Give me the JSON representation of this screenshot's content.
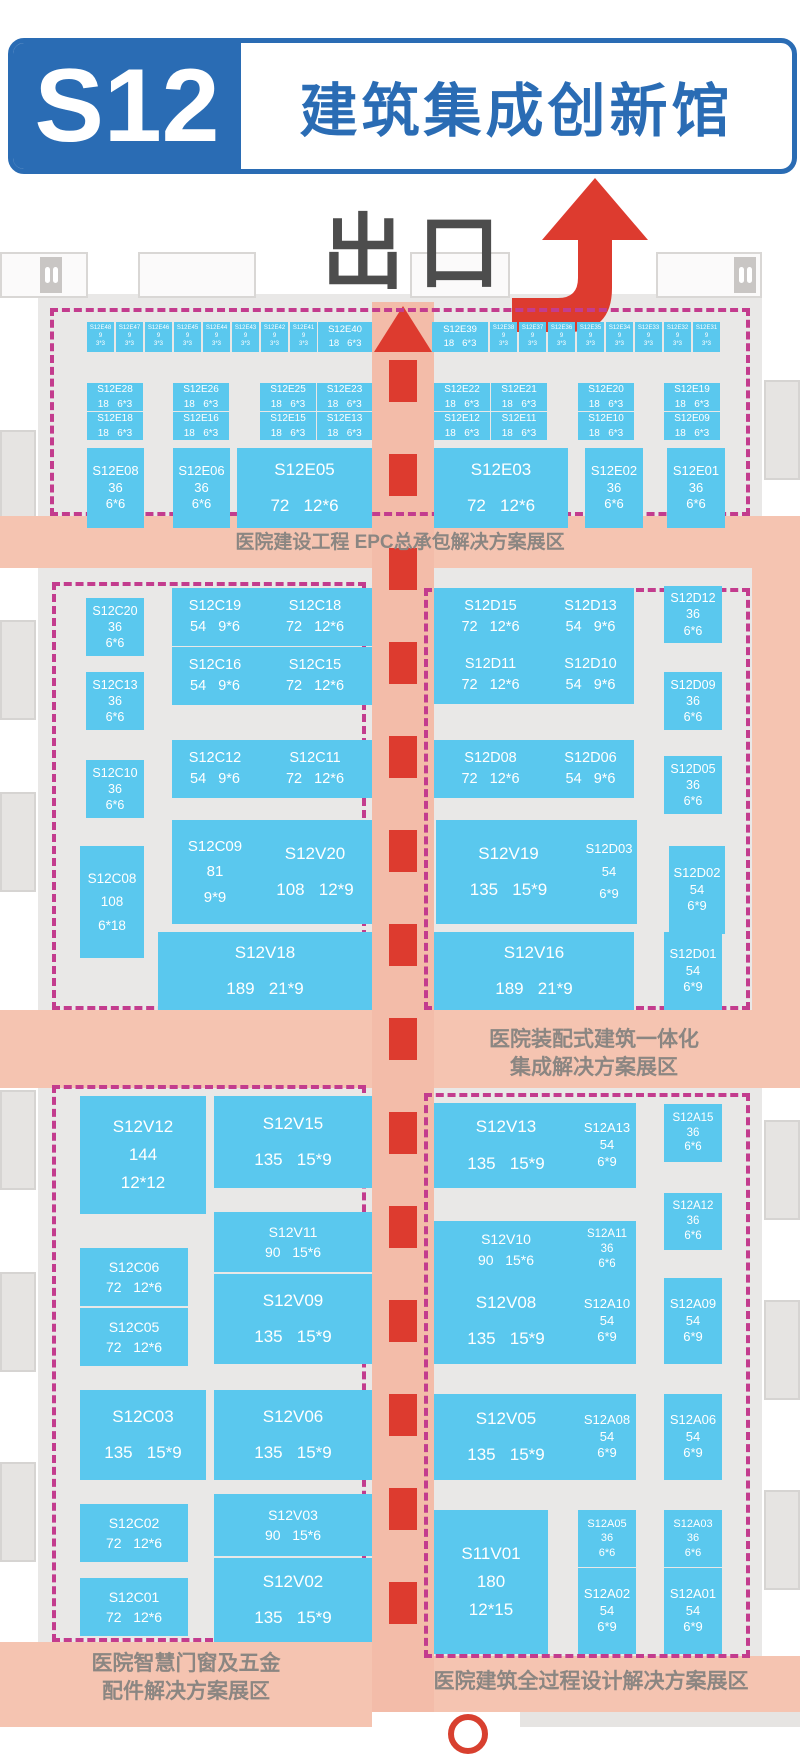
{
  "header": {
    "hall_code": "S12",
    "hall_name": "建筑集成创新馆"
  },
  "exit_label": "出口",
  "zones": {
    "epc": "医院建设工程 EPC总承包解决方案展区",
    "prefab_line1": "医院装配式建筑一体化",
    "prefab_line2": "集成解决方案展区",
    "windows_line1": "医院智慧门窗及五金",
    "windows_line2": "配件解决方案展区",
    "design": "医院建筑全过程设计解决方案展区"
  },
  "colors": {
    "header_blue": "#2a6cb4",
    "booth_cyan": "#5ac8ee",
    "zone_salmon": "#f5c4b1",
    "corridor_salmon": "#f3bca9",
    "dashed_pink": "#c33c8e",
    "arrow_red": "#dd3b2f",
    "exit_gray": "#4d4d4d",
    "zone_text_gray": "#8b8682",
    "floor_gray": "#e9e8e7"
  },
  "booths": [
    {
      "id": "S12E48",
      "area": "9",
      "dims": "3*3",
      "x": 87,
      "y": 322,
      "w": 27,
      "h": 30,
      "t": "t",
      "fs": 6
    },
    {
      "id": "S12E47",
      "area": "9",
      "dims": "3*3",
      "x": 116,
      "y": 322,
      "w": 27,
      "h": 30,
      "t": "t",
      "fs": 6
    },
    {
      "id": "S12E46",
      "area": "9",
      "dims": "3*3",
      "x": 145,
      "y": 322,
      "w": 27,
      "h": 30,
      "t": "t",
      "fs": 6
    },
    {
      "id": "S12E45",
      "area": "9",
      "dims": "3*3",
      "x": 174,
      "y": 322,
      "w": 27,
      "h": 30,
      "t": "t",
      "fs": 6
    },
    {
      "id": "S12E44",
      "area": "9",
      "dims": "3*3",
      "x": 203,
      "y": 322,
      "w": 27,
      "h": 30,
      "t": "t",
      "fs": 6
    },
    {
      "id": "S12E43",
      "area": "9",
      "dims": "3*3",
      "x": 232,
      "y": 322,
      "w": 27,
      "h": 30,
      "t": "t",
      "fs": 6
    },
    {
      "id": "S12E42",
      "area": "9",
      "dims": "3*3",
      "x": 261,
      "y": 322,
      "w": 27,
      "h": 30,
      "t": "t",
      "fs": 6
    },
    {
      "id": "S12E41",
      "area": "9",
      "dims": "3*3",
      "x": 290,
      "y": 322,
      "w": 27,
      "h": 30,
      "t": "t",
      "fs": 6
    },
    {
      "id": "S12E40",
      "area": "18",
      "dims": "6*3",
      "x": 318,
      "y": 322,
      "w": 54,
      "h": 30,
      "t": "2",
      "fs": 9.5
    },
    {
      "id": "S12E39",
      "area": "18",
      "dims": "6*3",
      "x": 432,
      "y": 322,
      "w": 56,
      "h": 30,
      "t": "2",
      "fs": 9.5
    },
    {
      "id": "S12E38",
      "area": "9",
      "dims": "3*3",
      "x": 490,
      "y": 322,
      "w": 27,
      "h": 30,
      "t": "t",
      "fs": 6
    },
    {
      "id": "S12E37",
      "area": "9",
      "dims": "3*3",
      "x": 519,
      "y": 322,
      "w": 27,
      "h": 30,
      "t": "t",
      "fs": 6
    },
    {
      "id": "S12E36",
      "area": "9",
      "dims": "3*3",
      "x": 548,
      "y": 322,
      "w": 27,
      "h": 30,
      "t": "t",
      "fs": 6
    },
    {
      "id": "S12E35",
      "area": "9",
      "dims": "3*3",
      "x": 577,
      "y": 322,
      "w": 27,
      "h": 30,
      "t": "t",
      "fs": 6
    },
    {
      "id": "S12E34",
      "area": "9",
      "dims": "3*3",
      "x": 606,
      "y": 322,
      "w": 27,
      "h": 30,
      "t": "t",
      "fs": 6
    },
    {
      "id": "S12E33",
      "area": "9",
      "dims": "3*3",
      "x": 635,
      "y": 322,
      "w": 27,
      "h": 30,
      "t": "t",
      "fs": 6
    },
    {
      "id": "S12E32",
      "area": "9",
      "dims": "3*3",
      "x": 664,
      "y": 322,
      "w": 27,
      "h": 30,
      "t": "t",
      "fs": 6
    },
    {
      "id": "S12E31",
      "area": "9",
      "dims": "3*3",
      "x": 693,
      "y": 322,
      "w": 27,
      "h": 30,
      "t": "t",
      "fs": 6
    },
    {
      "id": "S12E28",
      "area": "18",
      "dims": "6*3",
      "x": 87,
      "y": 383,
      "w": 56,
      "h": 28,
      "t": "2",
      "fs": 10
    },
    {
      "id": "S12E26",
      "area": "18",
      "dims": "6*3",
      "x": 173,
      "y": 383,
      "w": 56,
      "h": 28,
      "t": "2",
      "fs": 10
    },
    {
      "id": "S12E25",
      "area": "18",
      "dims": "6*3",
      "x": 260,
      "y": 383,
      "w": 56,
      "h": 28,
      "t": "2",
      "fs": 10
    },
    {
      "id": "S12E23",
      "area": "18",
      "dims": "6*3",
      "x": 317,
      "y": 383,
      "w": 55,
      "h": 28,
      "t": "2",
      "fs": 10
    },
    {
      "id": "S12E22",
      "area": "18",
      "dims": "6*3",
      "x": 434,
      "y": 383,
      "w": 56,
      "h": 28,
      "t": "2",
      "fs": 10
    },
    {
      "id": "S12E21",
      "area": "18",
      "dims": "6*3",
      "x": 491,
      "y": 383,
      "w": 56,
      "h": 28,
      "t": "2",
      "fs": 10
    },
    {
      "id": "S12E20",
      "area": "18",
      "dims": "6*3",
      "x": 578,
      "y": 383,
      "w": 56,
      "h": 28,
      "t": "2",
      "fs": 10
    },
    {
      "id": "S12E19",
      "area": "18",
      "dims": "6*3",
      "x": 664,
      "y": 383,
      "w": 56,
      "h": 28,
      "t": "2",
      "fs": 10
    },
    {
      "id": "S12E18",
      "area": "18",
      "dims": "6*3",
      "x": 87,
      "y": 412,
      "w": 56,
      "h": 28,
      "t": "2",
      "fs": 10
    },
    {
      "id": "S12E16",
      "area": "18",
      "dims": "6*3",
      "x": 173,
      "y": 412,
      "w": 56,
      "h": 28,
      "t": "2",
      "fs": 10
    },
    {
      "id": "S12E15",
      "area": "18",
      "dims": "6*3",
      "x": 260,
      "y": 412,
      "w": 56,
      "h": 28,
      "t": "2",
      "fs": 10
    },
    {
      "id": "S12E13",
      "area": "18",
      "dims": "6*3",
      "x": 317,
      "y": 412,
      "w": 55,
      "h": 28,
      "t": "2",
      "fs": 10
    },
    {
      "id": "S12E12",
      "area": "18",
      "dims": "6*3",
      "x": 434,
      "y": 412,
      "w": 56,
      "h": 28,
      "t": "2",
      "fs": 10
    },
    {
      "id": "S12E11",
      "area": "18",
      "dims": "6*3",
      "x": 491,
      "y": 412,
      "w": 56,
      "h": 28,
      "t": "2",
      "fs": 10
    },
    {
      "id": "S12E10",
      "area": "18",
      "dims": "6*3",
      "x": 578,
      "y": 412,
      "w": 56,
      "h": 28,
      "t": "2",
      "fs": 10
    },
    {
      "id": "S12E09",
      "area": "18",
      "dims": "6*3",
      "x": 664,
      "y": 412,
      "w": 56,
      "h": 28,
      "t": "2",
      "fs": 10
    },
    {
      "id": "S12E08",
      "area": "36",
      "dims": "6*6",
      "x": 87,
      "y": 448,
      "w": 57,
      "h": 80,
      "t": "3",
      "fs": 13
    },
    {
      "id": "S12E06",
      "area": "36",
      "dims": "6*6",
      "x": 173,
      "y": 448,
      "w": 57,
      "h": 80,
      "t": "3",
      "fs": 13
    },
    {
      "id": "S12E05",
      "area": "72",
      "dims": "12*6",
      "x": 237,
      "y": 448,
      "w": 135,
      "h": 80,
      "t": "2",
      "fs": 17
    },
    {
      "id": "S12E03",
      "area": "72",
      "dims": "12*6",
      "x": 434,
      "y": 448,
      "w": 134,
      "h": 80,
      "t": "2",
      "fs": 17
    },
    {
      "id": "S12E02",
      "area": "36",
      "dims": "6*6",
      "x": 585,
      "y": 448,
      "w": 58,
      "h": 80,
      "t": "3",
      "fs": 13
    },
    {
      "id": "S12E01",
      "area": "36",
      "dims": "6*6",
      "x": 667,
      "y": 448,
      "w": 58,
      "h": 80,
      "t": "3",
      "fs": 13
    },
    {
      "id": "S12C20",
      "area": "36",
      "dims": "6*6",
      "x": 86,
      "y": 598,
      "w": 58,
      "h": 58,
      "t": "3",
      "fs": 12.5
    },
    {
      "id": "S12C19",
      "area": "54",
      "dims": "9*6",
      "x": 172,
      "y": 588,
      "w": 86,
      "h": 58,
      "t": "2",
      "fs": 14.5
    },
    {
      "id": "S12C18",
      "area": "72",
      "dims": "12*6",
      "x": 258,
      "y": 588,
      "w": 114,
      "h": 58,
      "t": "2",
      "fs": 14.5
    },
    {
      "id": "S12C16",
      "area": "54",
      "dims": "9*6",
      "x": 172,
      "y": 647,
      "w": 86,
      "h": 58,
      "t": "2",
      "fs": 14.5
    },
    {
      "id": "S12C15",
      "area": "72",
      "dims": "12*6",
      "x": 258,
      "y": 647,
      "w": 114,
      "h": 58,
      "t": "2",
      "fs": 14.5
    },
    {
      "id": "S12C13",
      "area": "36",
      "dims": "6*6",
      "x": 86,
      "y": 672,
      "w": 58,
      "h": 58,
      "t": "3",
      "fs": 12.5
    },
    {
      "id": "S12C12",
      "area": "54",
      "dims": "9*6",
      "x": 172,
      "y": 740,
      "w": 86,
      "h": 58,
      "t": "2",
      "fs": 14.5
    },
    {
      "id": "S12C11",
      "area": "72",
      "dims": "12*6",
      "x": 258,
      "y": 740,
      "w": 114,
      "h": 58,
      "t": "2",
      "fs": 14.5
    },
    {
      "id": "S12C10",
      "area": "36",
      "dims": "6*6",
      "x": 86,
      "y": 760,
      "w": 58,
      "h": 58,
      "t": "3",
      "fs": 12.5
    },
    {
      "id": "S12C09",
      "area": "81",
      "dims": "9*9",
      "x": 172,
      "y": 820,
      "w": 86,
      "h": 104,
      "t": "3",
      "fs": 15
    },
    {
      "id": "S12V20",
      "area": "108",
      "dims": "12*9",
      "x": 258,
      "y": 820,
      "w": 114,
      "h": 104,
      "t": "2",
      "fs": 17
    },
    {
      "id": "S12C08",
      "area": "108",
      "dims": "6*18",
      "x": 80,
      "y": 846,
      "w": 64,
      "h": 112,
      "t": "3",
      "fs": 13.5
    },
    {
      "id": "S12V18",
      "area": "189",
      "dims": "21*9",
      "x": 158,
      "y": 932,
      "w": 214,
      "h": 78,
      "t": "2",
      "fs": 17
    },
    {
      "id": "S12D15",
      "area": "72",
      "dims": "12*6",
      "x": 434,
      "y": 588,
      "w": 113,
      "h": 58,
      "t": "2",
      "fs": 14.5
    },
    {
      "id": "S12D13",
      "area": "54",
      "dims": "9*6",
      "x": 547,
      "y": 588,
      "w": 87,
      "h": 58,
      "t": "2",
      "fs": 14.5
    },
    {
      "id": "S12D12",
      "area": "36",
      "dims": "6*6",
      "x": 664,
      "y": 586,
      "w": 58,
      "h": 57,
      "t": "3",
      "fs": 12.5
    },
    {
      "id": "S12D11",
      "area": "72",
      "dims": "12*6",
      "x": 434,
      "y": 646,
      "w": 113,
      "h": 58,
      "t": "2",
      "fs": 14.5
    },
    {
      "id": "S12D10",
      "area": "54",
      "dims": "9*6",
      "x": 547,
      "y": 646,
      "w": 87,
      "h": 58,
      "t": "2",
      "fs": 14.5
    },
    {
      "id": "S12D09",
      "area": "36",
      "dims": "6*6",
      "x": 664,
      "y": 672,
      "w": 58,
      "h": 58,
      "t": "3",
      "fs": 12.5
    },
    {
      "id": "S12D08",
      "area": "72",
      "dims": "12*6",
      "x": 434,
      "y": 740,
      "w": 113,
      "h": 58,
      "t": "2",
      "fs": 14.5
    },
    {
      "id": "S12D06",
      "area": "54",
      "dims": "9*6",
      "x": 547,
      "y": 740,
      "w": 87,
      "h": 58,
      "t": "2",
      "fs": 14.5
    },
    {
      "id": "S12D05",
      "area": "36",
      "dims": "6*6",
      "x": 664,
      "y": 756,
      "w": 58,
      "h": 58,
      "t": "3",
      "fs": 12.5
    },
    {
      "id": "S12V19",
      "area": "135",
      "dims": "15*9",
      "x": 436,
      "y": 820,
      "w": 145,
      "h": 104,
      "t": "2",
      "fs": 17
    },
    {
      "id": "S12D03",
      "area": "54",
      "dims": "6*9",
      "x": 581,
      "y": 820,
      "w": 56,
      "h": 104,
      "t": "3",
      "fs": 13
    },
    {
      "id": "S12D02",
      "area": "54",
      "dims": "6*9",
      "x": 669,
      "y": 846,
      "w": 56,
      "h": 88,
      "t": "3",
      "fs": 13
    },
    {
      "id": "S12V16",
      "area": "189",
      "dims": "21*9",
      "x": 434,
      "y": 932,
      "w": 200,
      "h": 78,
      "t": "2",
      "fs": 17
    },
    {
      "id": "S12D01",
      "area": "54",
      "dims": "6*9",
      "x": 664,
      "y": 932,
      "w": 58,
      "h": 78,
      "t": "3",
      "fs": 13
    },
    {
      "id": "S12V12",
      "area": "144",
      "dims": "12*12",
      "x": 80,
      "y": 1096,
      "w": 126,
      "h": 118,
      "t": "3",
      "fs": 17
    },
    {
      "id": "S12V15",
      "area": "135",
      "dims": "15*9",
      "x": 214,
      "y": 1096,
      "w": 158,
      "h": 92,
      "t": "2",
      "fs": 17
    },
    {
      "id": "S12C06",
      "area": "72",
      "dims": "12*6",
      "x": 80,
      "y": 1248,
      "w": 108,
      "h": 58,
      "t": "2",
      "fs": 14
    },
    {
      "id": "S12V11",
      "area": "90",
      "dims": "15*6",
      "x": 214,
      "y": 1212,
      "w": 158,
      "h": 60,
      "t": "2",
      "fs": 14
    },
    {
      "id": "S12C05",
      "area": "72",
      "dims": "12*6",
      "x": 80,
      "y": 1308,
      "w": 108,
      "h": 58,
      "t": "2",
      "fs": 14
    },
    {
      "id": "S12V09",
      "area": "135",
      "dims": "15*9",
      "x": 214,
      "y": 1274,
      "w": 158,
      "h": 90,
      "t": "2",
      "fs": 17
    },
    {
      "id": "S12C03",
      "area": "135",
      "dims": "15*9",
      "x": 80,
      "y": 1390,
      "w": 126,
      "h": 90,
      "t": "2",
      "fs": 17
    },
    {
      "id": "S12V06",
      "area": "135",
      "dims": "15*9",
      "x": 214,
      "y": 1390,
      "w": 158,
      "h": 90,
      "t": "2",
      "fs": 17
    },
    {
      "id": "S12C02",
      "area": "72",
      "dims": "12*6",
      "x": 80,
      "y": 1504,
      "w": 108,
      "h": 58,
      "t": "2",
      "fs": 14
    },
    {
      "id": "S12V03",
      "area": "90",
      "dims": "15*6",
      "x": 214,
      "y": 1494,
      "w": 158,
      "h": 62,
      "t": "2",
      "fs": 14
    },
    {
      "id": "S12C01",
      "area": "72",
      "dims": "12*6",
      "x": 80,
      "y": 1578,
      "w": 108,
      "h": 58,
      "t": "2",
      "fs": 14
    },
    {
      "id": "S12V02",
      "area": "135",
      "dims": "15*9",
      "x": 214,
      "y": 1558,
      "w": 158,
      "h": 84,
      "t": "2",
      "fs": 17
    },
    {
      "id": "S12V13",
      "area": "135",
      "dims": "15*9",
      "x": 434,
      "y": 1103,
      "w": 144,
      "h": 85,
      "t": "2",
      "fs": 17
    },
    {
      "id": "S12A13",
      "area": "54",
      "dims": "6*9",
      "x": 578,
      "y": 1103,
      "w": 58,
      "h": 85,
      "t": "3",
      "fs": 13
    },
    {
      "id": "S12A15",
      "area": "36",
      "dims": "6*6",
      "x": 664,
      "y": 1104,
      "w": 58,
      "h": 58,
      "t": "3",
      "fs": 11.5
    },
    {
      "id": "S12A12",
      "area": "36",
      "dims": "6*6",
      "x": 664,
      "y": 1193,
      "w": 58,
      "h": 57,
      "t": "3",
      "fs": 11.5
    },
    {
      "id": "S12V10",
      "area": "90",
      "dims": "15*6",
      "x": 434,
      "y": 1221,
      "w": 144,
      "h": 57,
      "t": "2",
      "fs": 14
    },
    {
      "id": "S12A11",
      "area": "36",
      "dims": "6*6",
      "x": 578,
      "y": 1221,
      "w": 58,
      "h": 57,
      "t": "3",
      "fs": 11.5
    },
    {
      "id": "S12V08",
      "area": "135",
      "dims": "15*9",
      "x": 434,
      "y": 1278,
      "w": 144,
      "h": 86,
      "t": "2",
      "fs": 17
    },
    {
      "id": "S12A10",
      "area": "54",
      "dims": "6*9",
      "x": 578,
      "y": 1278,
      "w": 58,
      "h": 86,
      "t": "3",
      "fs": 13
    },
    {
      "id": "S12A09",
      "area": "54",
      "dims": "6*9",
      "x": 664,
      "y": 1278,
      "w": 58,
      "h": 86,
      "t": "3",
      "fs": 13
    },
    {
      "id": "S12V05",
      "area": "135",
      "dims": "15*9",
      "x": 434,
      "y": 1394,
      "w": 144,
      "h": 86,
      "t": "2",
      "fs": 17
    },
    {
      "id": "S12A08",
      "area": "54",
      "dims": "6*9",
      "x": 578,
      "y": 1394,
      "w": 58,
      "h": 86,
      "t": "3",
      "fs": 13
    },
    {
      "id": "S12A06",
      "area": "54",
      "dims": "6*9",
      "x": 664,
      "y": 1394,
      "w": 58,
      "h": 86,
      "t": "3",
      "fs": 13
    },
    {
      "id": "S11V01",
      "area": "180",
      "dims": "12*15",
      "x": 434,
      "y": 1510,
      "w": 114,
      "h": 144,
      "t": "3",
      "fs": 17
    },
    {
      "id": "S12A05",
      "area": "36",
      "dims": "6*6",
      "x": 578,
      "y": 1510,
      "w": 58,
      "h": 57,
      "t": "3",
      "fs": 11
    },
    {
      "id": "S12A03",
      "area": "36",
      "dims": "6*6",
      "x": 664,
      "y": 1510,
      "w": 58,
      "h": 57,
      "t": "3",
      "fs": 11
    },
    {
      "id": "S12A02",
      "area": "54",
      "dims": "6*9",
      "x": 578,
      "y": 1568,
      "w": 58,
      "h": 86,
      "t": "3",
      "fs": 13
    },
    {
      "id": "S12A01",
      "area": "54",
      "dims": "6*9",
      "x": 664,
      "y": 1568,
      "w": 58,
      "h": 86,
      "t": "3",
      "fs": 13
    }
  ]
}
